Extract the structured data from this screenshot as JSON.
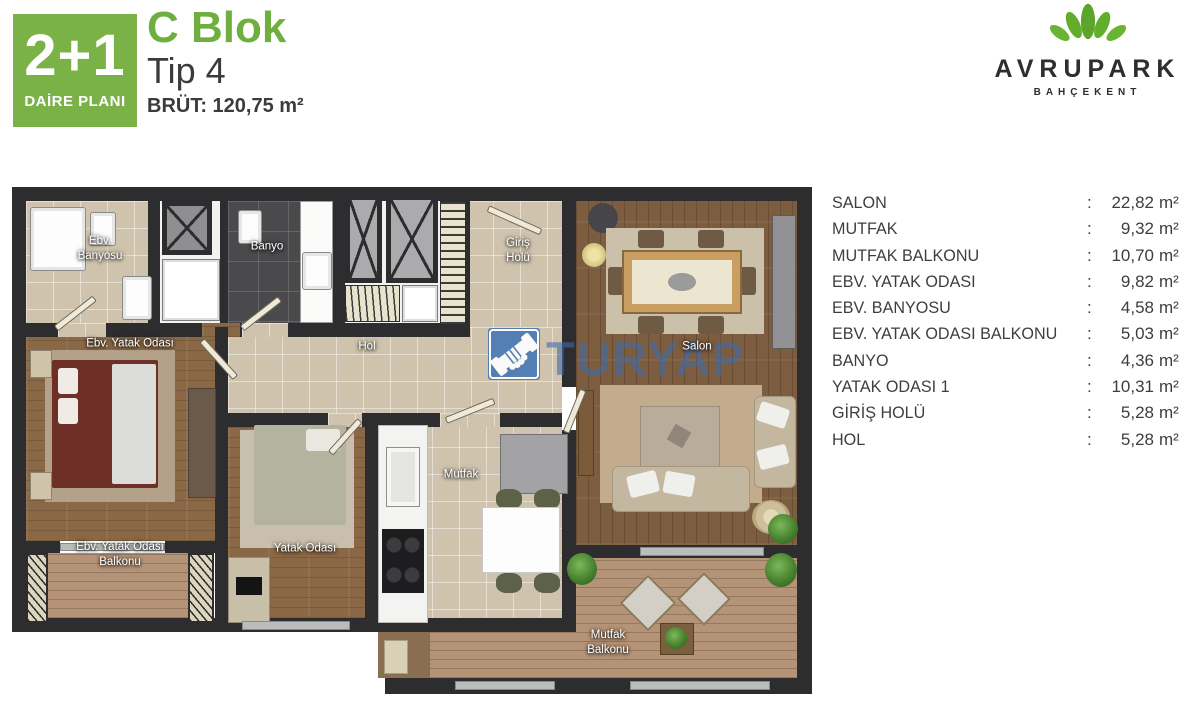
{
  "header": {
    "badge": {
      "line1": "2+1",
      "line2": "DAİRE PLANI",
      "color": "#7ab247"
    },
    "block": "C Blok",
    "type": "Tip 4",
    "gross": "BRÜT: 120,75 m²",
    "brand": {
      "name": "AVRUPARK",
      "sub": "BAHÇEKENT",
      "icon": "lotus-leaves-icon",
      "green": "#5ca52a"
    }
  },
  "watermark": {
    "text": "TURYAP",
    "icon": "handshake-icon",
    "blue": "#4b7ab6"
  },
  "plan": {
    "labels": [
      {
        "id": "room-label-ebv-banyosu",
        "lines": [
          "Ebv.",
          "Banyosu"
        ],
        "x": 90,
        "y": 64
      },
      {
        "id": "room-label-banyo",
        "lines": [
          "Banyo"
        ],
        "x": 257,
        "y": 62
      },
      {
        "id": "room-label-giris-holu",
        "lines": [
          "Giriş",
          "Holü"
        ],
        "x": 508,
        "y": 66
      },
      {
        "id": "room-label-ebv-yatak-odasi",
        "lines": [
          "Ebv. Yatak Odası"
        ],
        "x": 120,
        "y": 159
      },
      {
        "id": "room-label-hol",
        "lines": [
          "Hol"
        ],
        "x": 357,
        "y": 162
      },
      {
        "id": "room-label-salon",
        "lines": [
          "Salon"
        ],
        "x": 687,
        "y": 162
      },
      {
        "id": "room-label-mutfak",
        "lines": [
          "Mutfak"
        ],
        "x": 451,
        "y": 290
      },
      {
        "id": "room-label-yatak-odasi",
        "lines": [
          "Yatak Odası"
        ],
        "x": 295,
        "y": 364
      },
      {
        "id": "room-label-ebv-yatak-odasi-balkonu",
        "lines": [
          "Ebv. Yatak Odası",
          "Balkonu"
        ],
        "x": 110,
        "y": 370
      },
      {
        "id": "room-label-mutfak-balkonu",
        "lines": [
          "Mutfak",
          "Balkonu"
        ],
        "x": 598,
        "y": 458
      }
    ]
  },
  "legend": {
    "unit": "m²",
    "rows": [
      {
        "label": "SALON",
        "value": "22,82"
      },
      {
        "label": "MUTFAK",
        "value": "9,32"
      },
      {
        "label": "MUTFAK BALKONU",
        "value": "10,70"
      },
      {
        "label": "EBV. YATAK ODASI",
        "value": "9,82"
      },
      {
        "label": "EBV. BANYOSU",
        "value": "4,58"
      },
      {
        "label": "EBV. YATAK ODASI BALKONU",
        "value": "5,03"
      },
      {
        "label": "BANYO",
        "value": "4,36"
      },
      {
        "label": "YATAK ODASI 1",
        "value": "10,31"
      },
      {
        "label": "GİRİŞ HOLÜ",
        "value": "5,28"
      },
      {
        "label": "HOL",
        "value": "5,28"
      }
    ]
  }
}
